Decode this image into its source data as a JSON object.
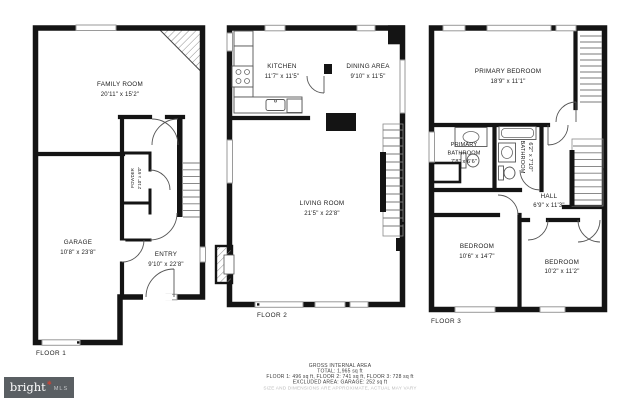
{
  "floors": [
    {
      "label": "FLOOR 1",
      "rooms": [
        {
          "lines": [
            "FAMILY ROOM",
            "20'11\" x 15'2\""
          ]
        },
        {
          "lines": [
            "GARAGE",
            "10'8\" x 23'8\""
          ]
        },
        {
          "lines": [
            "ENTRY",
            "9'10\" x 22'8\""
          ]
        },
        {
          "lines": [
            "POWDER",
            "2'10\" x 6'0\""
          ]
        }
      ]
    },
    {
      "label": "FLOOR 2",
      "rooms": [
        {
          "lines": [
            "KITCHEN",
            "11'7\" x 11'5\""
          ]
        },
        {
          "lines": [
            "DINING AREA",
            "9'10\" x 11'5\""
          ]
        },
        {
          "lines": [
            "LIVING ROOM",
            "21'5\" x 22'8\""
          ]
        }
      ]
    },
    {
      "label": "FLOOR 3",
      "rooms": [
        {
          "lines": [
            "PRIMARY BEDROOM",
            "18'9\" x 11'1\""
          ]
        },
        {
          "lines": [
            "PRIMARY",
            "BATHROOM",
            "7'8\" x 6'6\""
          ]
        },
        {
          "lines": [
            "BATHROOM",
            "6'2\" x 7'10\""
          ]
        },
        {
          "lines": [
            "HALL",
            "6'9\" x 11'3\""
          ]
        },
        {
          "lines": [
            "BEDROOM",
            "10'6\" x 14'7\""
          ]
        },
        {
          "lines": [
            "BEDROOM",
            "10'2\" x 11'2\""
          ]
        }
      ]
    }
  ],
  "footer": {
    "line1": "GROSS INTERNAL AREA",
    "line2": "TOTAL: 1,965 sq ft",
    "line3": "FLOOR 1: 496 sq ft, FLOOR 2: 741 sq ft, FLOOR 3: 728 sq ft",
    "line4": "EXCLUDED AREA: GARAGE: 252 sq ft",
    "line5": "SIZE AND DIMENSIONS ARE APPROXIMATE, ACTUAL MAY VARY"
  },
  "logo": {
    "brand": "bright",
    "star": "✱",
    "suffix": "MLS",
    "background": "#5a5f63",
    "accent": "#c2473a"
  },
  "colors": {
    "wall": "#141414",
    "window_frame": "#9a9a9a",
    "note_gray": "#bdbdbd"
  }
}
